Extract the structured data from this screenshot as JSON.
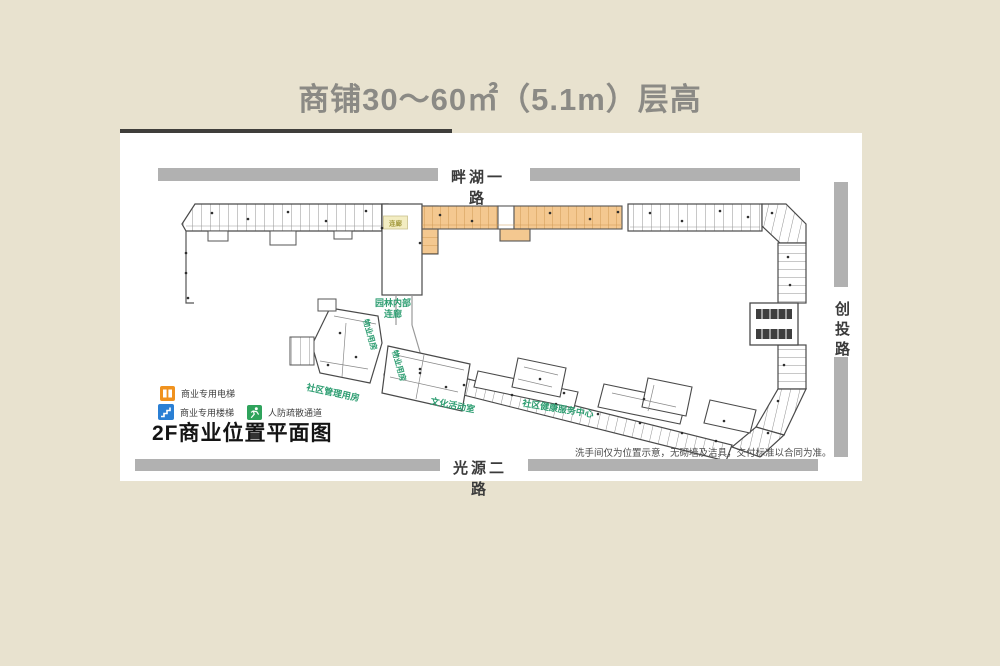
{
  "page": {
    "title": "商铺30～60㎡（5.1m）层高"
  },
  "roads": {
    "top": "畔湖一路",
    "right": "创投路",
    "bottom": "光源二路"
  },
  "plan": {
    "title": "2F商业位置平面图",
    "corridor_box": "连廊",
    "labels": {
      "garden_line1": "园林内部",
      "garden_line2": "连廊",
      "property_room_a": "物业用房",
      "property_room_b": "物业用房",
      "community_mgmt": "社区管理用房",
      "culture_room": "文化活动室",
      "health_center": "社区健康服务中心"
    },
    "disclaimer": "洗手间仅为位置示意，无砌墙及洁具，交付标准以合同为准。"
  },
  "legend": {
    "items": [
      {
        "icon": "elevator-icon",
        "label": "商业专用电梯",
        "color": "#f0921e"
      },
      {
        "icon": "stairs-icon",
        "label": "商业专用楼梯",
        "color": "#2a7fd4"
      },
      {
        "icon": "evacuation-icon",
        "label": "人防疏散通道",
        "color": "#2fa35c"
      }
    ]
  },
  "colors": {
    "background": "#e8e2cf",
    "panel": "#ffffff",
    "road_bar": "#b1b1b1",
    "title_text": "#8b8a85",
    "road_text": "#3b3b3b",
    "highlight_unit": "#f4c890",
    "label_green": "#2e9e72",
    "plan_outline": "#4a4a4a"
  }
}
